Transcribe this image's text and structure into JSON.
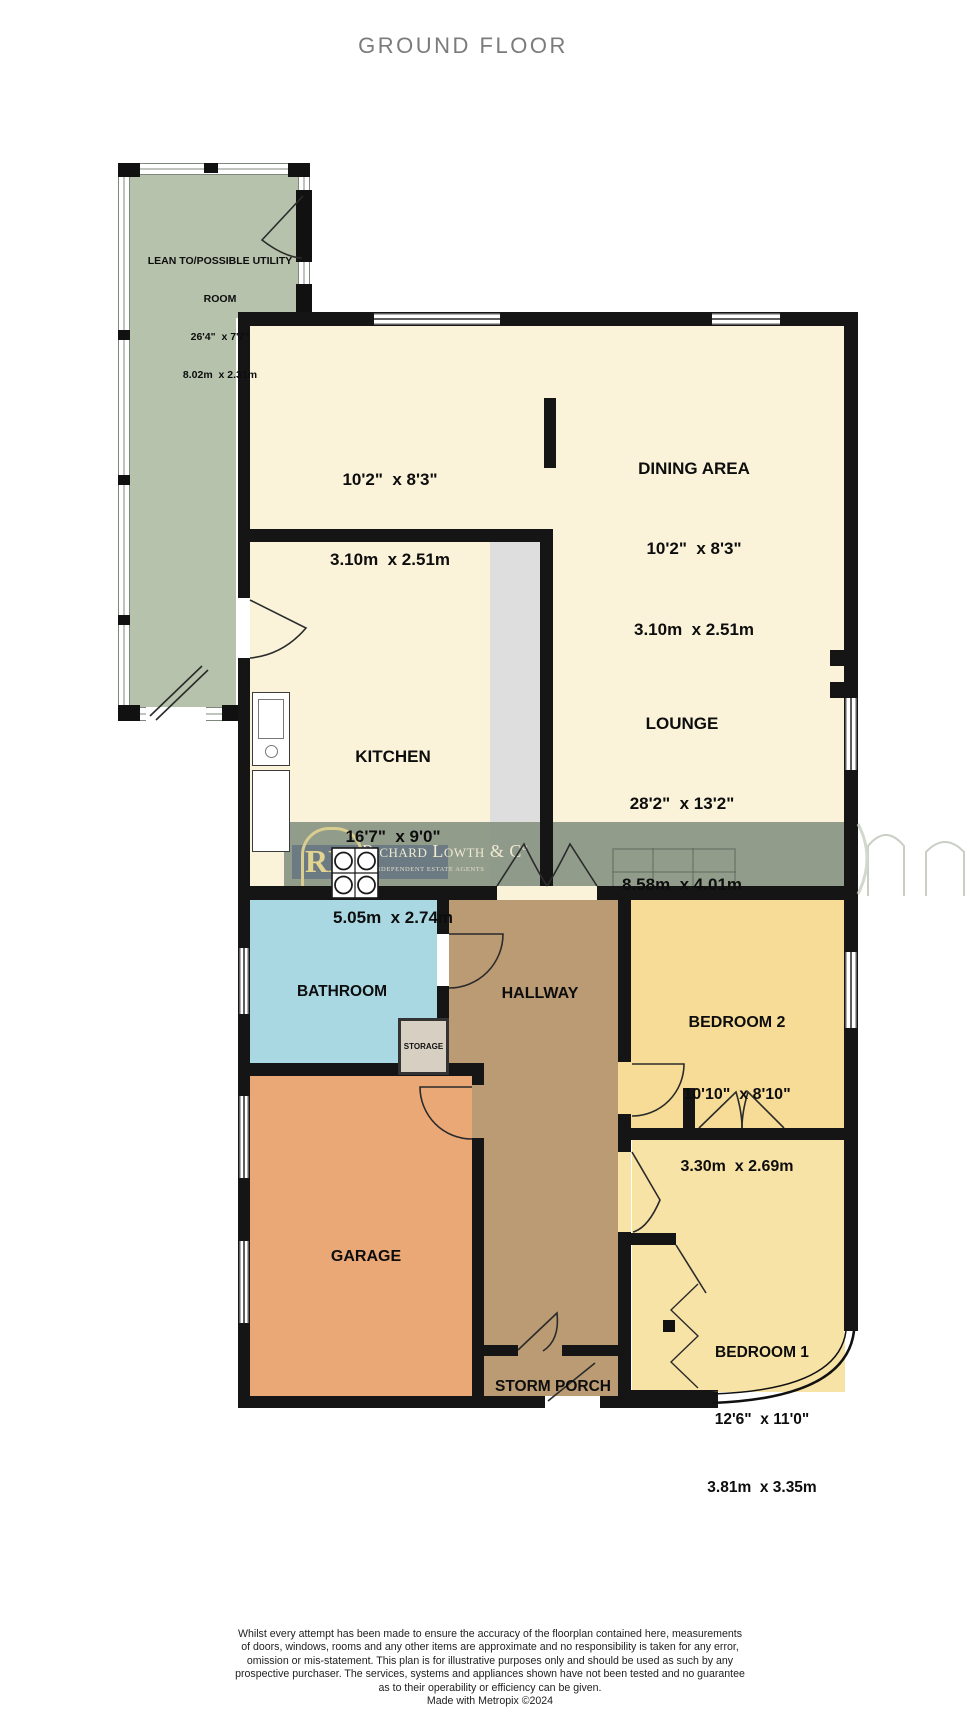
{
  "title": "GROUND FLOOR",
  "rooms": {
    "lean_to": [
      "LEAN TO/POSSIBLE UTILITY",
      "ROOM",
      "26'4\"  x 7'7\"",
      "8.02m  x 2.31m"
    ],
    "dining_left": [
      "10'2\"  x 8'3\"",
      "3.10m  x 2.51m"
    ],
    "dining": [
      "DINING AREA",
      "10'2\"  x 8'3\"",
      "3.10m  x 2.51m"
    ],
    "kitchen": [
      "KITCHEN",
      "16'7\"  x 9'0\"",
      "5.05m  x 2.74m"
    ],
    "lounge": [
      "LOUNGE",
      "28'2\"  x 13'2\"",
      "8.58m  x 4.01m"
    ],
    "bathroom": "BATHROOM",
    "hallway": "HALLWAY",
    "storage": "STORAGE",
    "bedroom2": [
      "BEDROOM 2",
      "10'10\"  x 8'10\"",
      "3.30m  x 2.69m"
    ],
    "garage": "GARAGE",
    "bedroom1": [
      "BEDROOM 1",
      "12'6\"  x 11'0\"",
      "3.81m  x 3.35m"
    ],
    "storm_porch": "STORM PORCH"
  },
  "watermark": {
    "monogram": "rl",
    "brand": "Richard Lowth & Cº",
    "tagline": "INDEPENDENT ESTATE AGENTS"
  },
  "footer": {
    "lines": [
      "Whilst every attempt has been made to ensure the accuracy of the floorplan contained here, measurements",
      "of doors, windows, rooms and any other items are approximate and no responsibility is taken for any error,",
      "omission or mis-statement. This plan is for illustrative purposes only and should be used as such by any",
      "prospective purchaser. The services, systems and appliances shown have not been tested and no guarantee",
      "as to their operability or efficiency can be given."
    ],
    "credit": "Made with Metropix ©2024"
  },
  "colors": {
    "cream_room": "#faf3da",
    "lean_to_sage": "#b6c2ac",
    "bathroom_blue": "#a9d7e2",
    "hallway_brown": "#bb9b74",
    "bedroom_yellow2": "#f6dc96",
    "bedroom_yellow1": "#f8e3a6",
    "garage_orange": "#eaa877",
    "wall_black": "#151515",
    "watermark_band": "#8f9c84",
    "title_gray": "#7b7b7b"
  }
}
